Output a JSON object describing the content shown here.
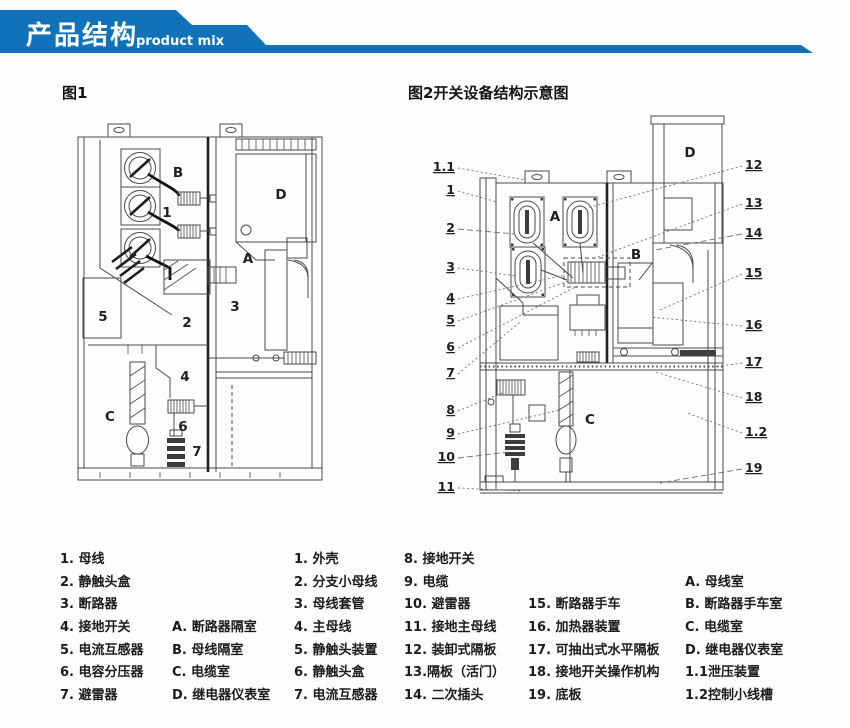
{
  "banner": {
    "title": "产品结构",
    "subtitle": "product mix",
    "color": "#1272b9"
  },
  "figures": {
    "fig1": {
      "title": "图1",
      "region_labels": [
        {
          "label": "B",
          "x": 118,
          "y": 67
        },
        {
          "label": "1",
          "x": 107,
          "y": 107
        },
        {
          "label": "D",
          "x": 221,
          "y": 89
        },
        {
          "label": "A",
          "x": 188,
          "y": 153
        },
        {
          "label": "5",
          "x": 43,
          "y": 211
        },
        {
          "label": "2",
          "x": 127,
          "y": 217
        },
        {
          "label": "3",
          "x": 175,
          "y": 201
        },
        {
          "label": "4",
          "x": 125,
          "y": 271
        },
        {
          "label": "C",
          "x": 50,
          "y": 311
        },
        {
          "label": "6",
          "x": 123,
          "y": 321
        },
        {
          "label": "7",
          "x": 137,
          "y": 346
        }
      ]
    },
    "fig2": {
      "title": "图2开关设备结构示意图",
      "callouts_left": [
        {
          "label": "1.1",
          "x": 30,
          "y": 61
        },
        {
          "label": "1",
          "x": 30,
          "y": 84
        },
        {
          "label": "2",
          "x": 30,
          "y": 122
        },
        {
          "label": "3",
          "x": 30,
          "y": 161
        },
        {
          "label": "4",
          "x": 30,
          "y": 192
        },
        {
          "label": "5",
          "x": 30,
          "y": 214
        },
        {
          "label": "6",
          "x": 30,
          "y": 241
        },
        {
          "label": "7",
          "x": 30,
          "y": 267
        },
        {
          "label": "8",
          "x": 30,
          "y": 304
        },
        {
          "label": "9",
          "x": 30,
          "y": 327
        },
        {
          "label": "10",
          "x": 30,
          "y": 351
        },
        {
          "label": "11",
          "x": 30,
          "y": 381
        }
      ],
      "callouts_right": [
        {
          "label": "12",
          "x": 320,
          "y": 59
        },
        {
          "label": "13",
          "x": 320,
          "y": 97
        },
        {
          "label": "14",
          "x": 320,
          "y": 127
        },
        {
          "label": "15",
          "x": 320,
          "y": 167
        },
        {
          "label": "16",
          "x": 320,
          "y": 219
        },
        {
          "label": "17",
          "x": 320,
          "y": 256
        },
        {
          "label": "18",
          "x": 320,
          "y": 291
        },
        {
          "label": "1.2",
          "x": 320,
          "y": 326
        },
        {
          "label": "19",
          "x": 320,
          "y": 362
        }
      ],
      "region_labels": [
        {
          "label": "A",
          "x": 130,
          "y": 111
        },
        {
          "label": "B",
          "x": 211,
          "y": 149
        },
        {
          "label": "C",
          "x": 165,
          "y": 314
        },
        {
          "label": "D",
          "x": 265,
          "y": 47
        }
      ]
    }
  },
  "legend": {
    "items": [
      {
        "x": 60,
        "y": 8,
        "label": "1. 母线"
      },
      {
        "x": 60,
        "y": 31,
        "label": "2. 静触头盒"
      },
      {
        "x": 60,
        "y": 53,
        "label": "3. 断路器"
      },
      {
        "x": 60,
        "y": 76,
        "label": "4. 接地开关"
      },
      {
        "x": 60,
        "y": 99,
        "label": "5. 电流互感器"
      },
      {
        "x": 60,
        "y": 121,
        "label": "6. 电容分压器"
      },
      {
        "x": 60,
        "y": 144,
        "label": "7. 避雷器"
      },
      {
        "x": 172,
        "y": 76,
        "label": "A. 断路器隔室"
      },
      {
        "x": 172,
        "y": 99,
        "label": "B. 母线隔室"
      },
      {
        "x": 172,
        "y": 121,
        "label": "C. 电缆室"
      },
      {
        "x": 172,
        "y": 144,
        "label": "D. 继电器仪表室"
      },
      {
        "x": 294,
        "y": 8,
        "label": "1. 外壳"
      },
      {
        "x": 294,
        "y": 31,
        "label": "2. 分支小母线"
      },
      {
        "x": 294,
        "y": 53,
        "label": "3. 母线套管"
      },
      {
        "x": 294,
        "y": 76,
        "label": "4. 主母线"
      },
      {
        "x": 294,
        "y": 99,
        "label": "5. 静触头装置"
      },
      {
        "x": 294,
        "y": 121,
        "label": "6. 静触头盒"
      },
      {
        "x": 294,
        "y": 144,
        "label": "7. 电流互感器"
      },
      {
        "x": 404,
        "y": 8,
        "label": "8. 接地开关"
      },
      {
        "x": 404,
        "y": 31,
        "label": "9. 电缆"
      },
      {
        "x": 404,
        "y": 53,
        "label": "10. 避雷器"
      },
      {
        "x": 404,
        "y": 76,
        "label": "11. 接地主母线"
      },
      {
        "x": 404,
        "y": 99,
        "label": "12. 装卸式隔板"
      },
      {
        "x": 404,
        "y": 121,
        "label": "13.隔板（活门）"
      },
      {
        "x": 404,
        "y": 144,
        "label": "14. 二次插头"
      },
      {
        "x": 528,
        "y": 53,
        "label": "15. 断路器手车"
      },
      {
        "x": 528,
        "y": 76,
        "label": "16. 加热器装置"
      },
      {
        "x": 528,
        "y": 99,
        "label": "17. 可抽出式水平隔板"
      },
      {
        "x": 528,
        "y": 121,
        "label": "18. 接地开关操作机构"
      },
      {
        "x": 528,
        "y": 144,
        "label": "19. 底板"
      },
      {
        "x": 685,
        "y": 31,
        "label": "A.  母线室"
      },
      {
        "x": 685,
        "y": 53,
        "label": "B.  断路器手车室"
      },
      {
        "x": 685,
        "y": 76,
        "label": "C.  电缆室"
      },
      {
        "x": 685,
        "y": 99,
        "label": "D.  继电器仪表室"
      },
      {
        "x": 685,
        "y": 121,
        "label": "1.1泄压装置"
      },
      {
        "x": 685,
        "y": 144,
        "label": "1.2控制小线槽"
      }
    ]
  }
}
